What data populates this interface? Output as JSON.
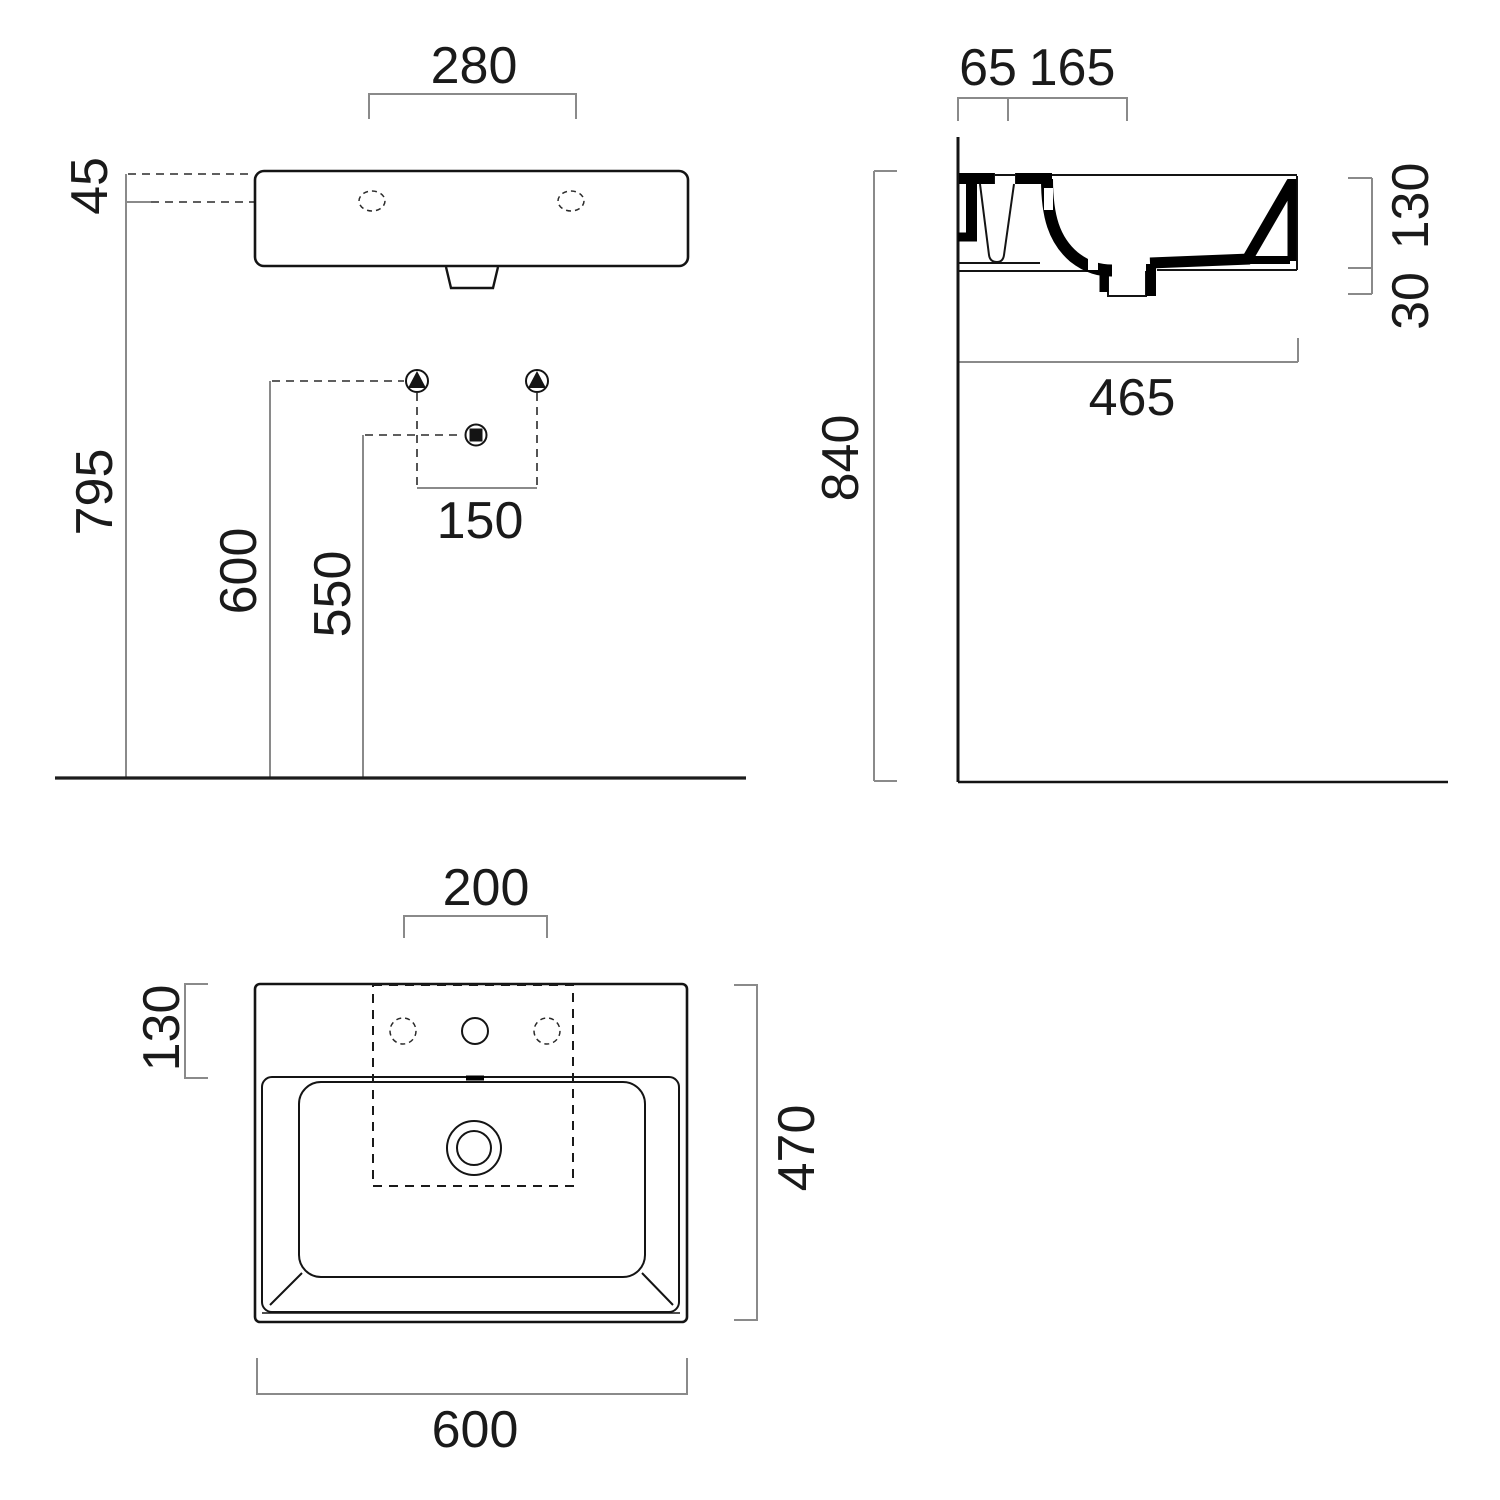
{
  "colors": {
    "background": "#ffffff",
    "outline": "#141414",
    "dim_line": "#8a8a8a",
    "text": "#1a1a1a"
  },
  "views": {
    "front": {
      "name": "front-elevation",
      "dims": {
        "faucet_hole_spacing": "280",
        "rim_to_hole_offset": "45",
        "rim_height": "795",
        "bracket_height": "600",
        "drain_height": "550",
        "bracket_spacing": "150"
      }
    },
    "side": {
      "name": "side-section",
      "dims": {
        "wall_ledge": "65",
        "back_shelf": "165",
        "rim_depth": "130",
        "underside_drop": "30",
        "total_depth": "465",
        "rim_floor_height": "840"
      }
    },
    "plan": {
      "name": "plan-view",
      "dims": {
        "tap_template_width": "200",
        "back_deck_depth": "130",
        "overall_depth": "470",
        "overall_width": "600"
      }
    }
  }
}
